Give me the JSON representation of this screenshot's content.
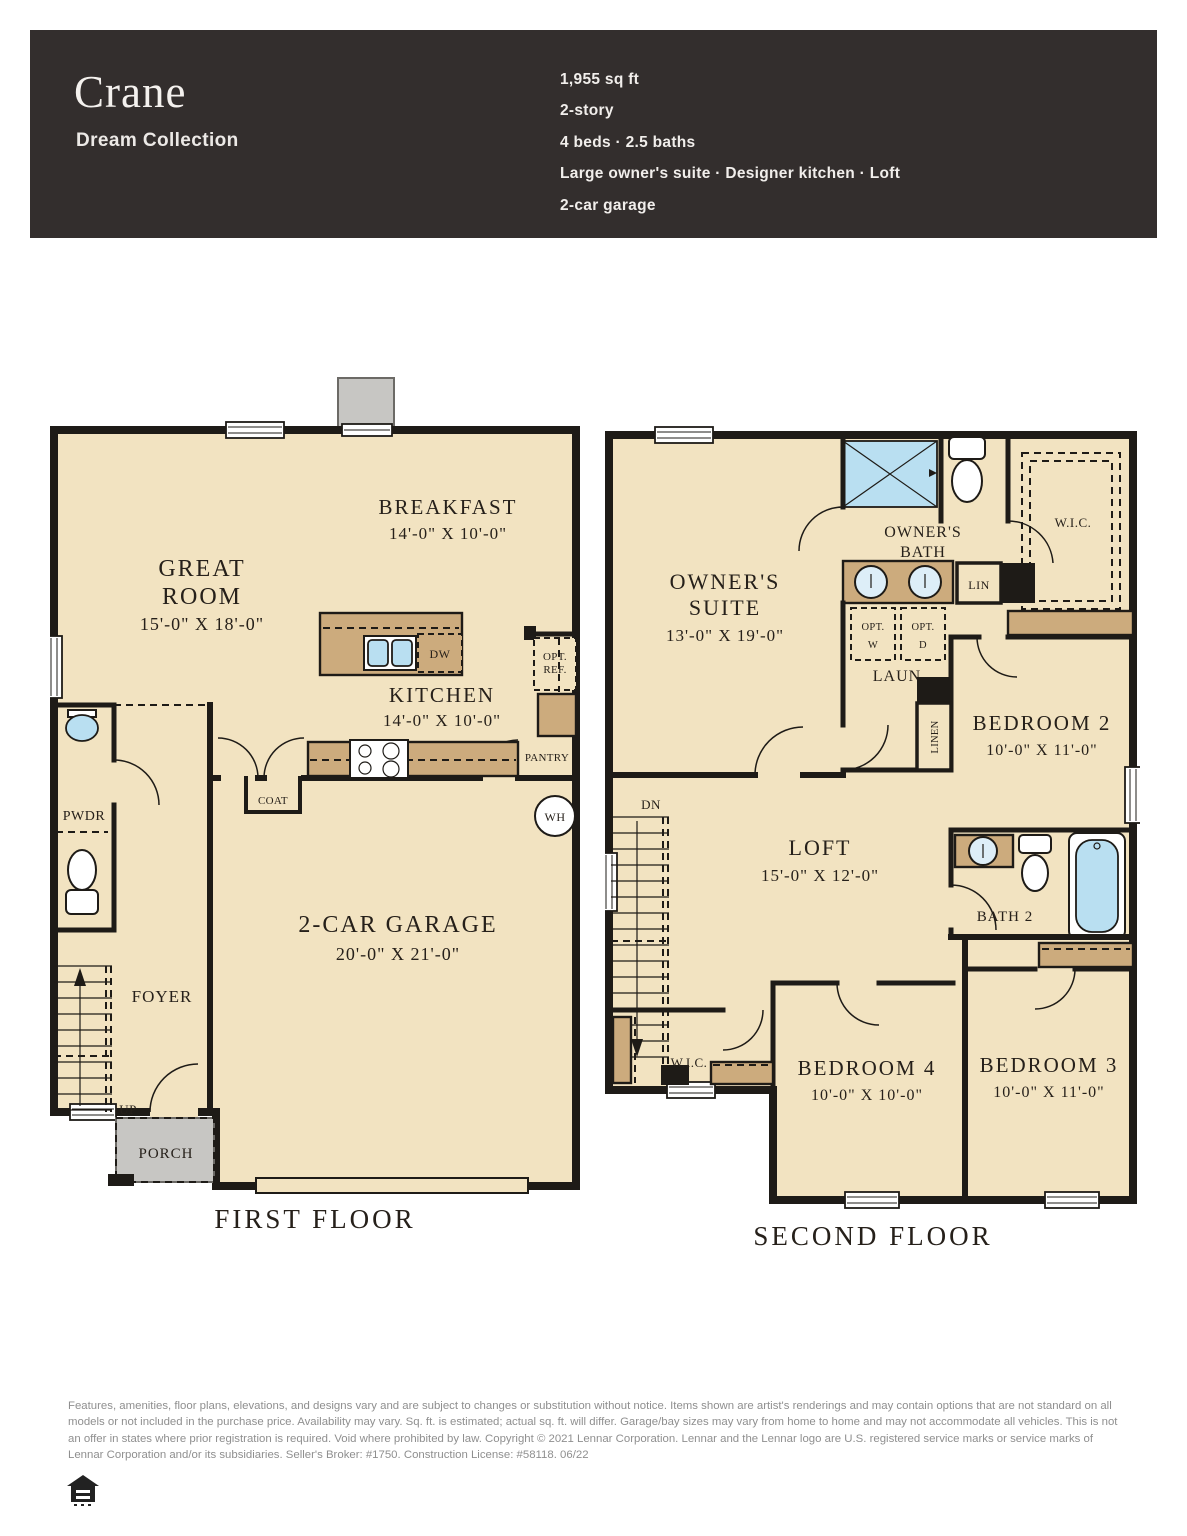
{
  "header": {
    "title": "Crane",
    "subtitle": "Dream Collection",
    "specs": [
      "1,955 sq ft",
      "2-story",
      "4 beds · 2.5 baths",
      "Large owner's suite · Designer kitchen · Loft",
      "2-car garage"
    ]
  },
  "first_floor": {
    "caption": "FIRST FLOOR",
    "great_room": {
      "line1": "GREAT",
      "line2": "ROOM",
      "dims": "15'-0\" X 18'-0\""
    },
    "breakfast": {
      "name": "BREAKFAST",
      "dims": "14'-0\" X 10'-0\""
    },
    "kitchen": {
      "name": "KITCHEN",
      "dims": "14'-0\" X 10'-0\""
    },
    "garage": {
      "name": "2-CAR GARAGE",
      "dims": "20'-0\" X 21'-0\""
    },
    "foyer": "FOYER",
    "porch": "PORCH",
    "pwdr": "PWDR",
    "coat": "COAT",
    "pantry": "PANTRY",
    "dw": "DW",
    "opt_ref_line1": "OPT.",
    "opt_ref_line2": "REF.",
    "wh": "WH",
    "up": "UP"
  },
  "second_floor": {
    "caption": "SECOND FLOOR",
    "owners_suite": {
      "line1": "OWNER'S",
      "line2": "SUITE",
      "dims": "13'-0\" X 19'-0\""
    },
    "owners_bath": {
      "line1": "OWNER'S",
      "line2": "BATH"
    },
    "wic": "W.I.C.",
    "wic2": "W.I.C.",
    "lin": "LIN",
    "linen": "LINEN",
    "opt_w_line1": "OPT.",
    "opt_w_line2": "W",
    "opt_d_line1": "OPT.",
    "opt_d_line2": "D",
    "laun": "LAUN",
    "dn": "DN",
    "loft": {
      "name": "LOFT",
      "dims": "15'-0\" X 12'-0\""
    },
    "bath2": "BATH 2",
    "bedroom2": {
      "name": "BEDROOM 2",
      "dims": "10'-0\" X 11'-0\""
    },
    "bedroom3": {
      "name": "BEDROOM 3",
      "dims": "10'-0\" X 11'-0\""
    },
    "bedroom4": {
      "name": "BEDROOM 4",
      "dims": "10'-0\" X 10'-0\""
    }
  },
  "footer": {
    "disclaimer": "Features, amenities, floor plans, elevations, and designs vary and are subject to changes or substitution without notice. Items shown are artist's renderings and may contain options that are not standard on all models or not included in the purchase price. Availability may vary. Sq. ft. is estimated; actual sq. ft. will differ. Garage/bay sizes may vary from home to home and may not accommodate all vehicles. This is not an offer in states where prior registration is required. Void where prohibited by law. Copyright © 2021 Lennar Corporation. Lennar and the Lennar logo are U.S. registered service marks or service marks of Lennar Corporation and/or its subsidiaries. Seller's Broker: #1750. Construction License: #58118. 06/22"
  },
  "colors": {
    "header_bg": "#332e2d",
    "floor_fill": "#f2e3c1",
    "counter_fill": "#ccab7d",
    "wall": "#1e1b17",
    "porch_fill": "#c7c6c3",
    "water_fill": "#b9dff1"
  }
}
